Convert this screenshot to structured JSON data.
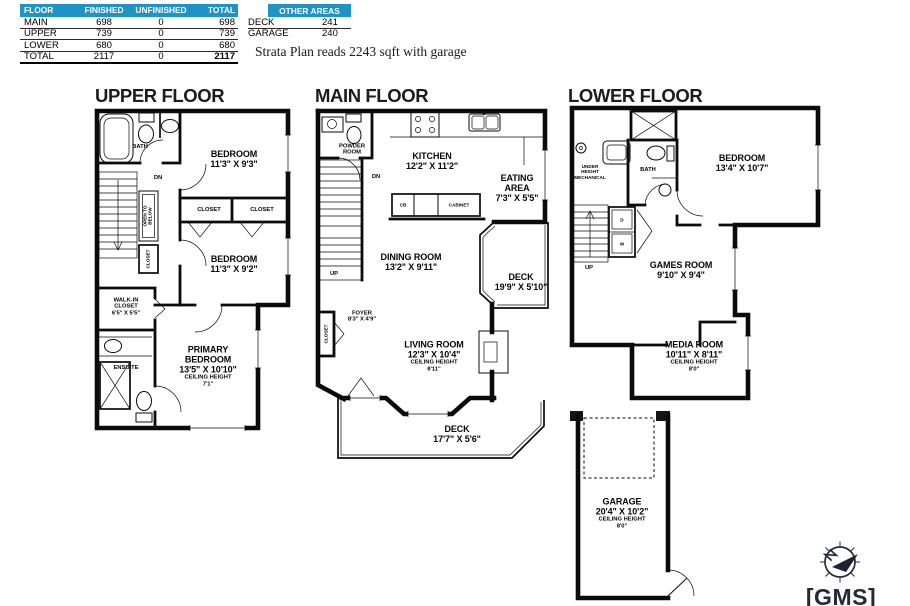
{
  "colors": {
    "header_blue": "#1e93c6",
    "wall_ink": "#0b0b0b",
    "logo_navy": "#232a38"
  },
  "summary_table": {
    "headers": [
      "FLOOR",
      "FINISHED",
      "UNFINISHED",
      "TOTAL"
    ],
    "rows": [
      [
        "MAIN",
        "698",
        "0",
        "698"
      ],
      [
        "UPPER",
        "739",
        "0",
        "739"
      ],
      [
        "LOWER",
        "680",
        "0",
        "680"
      ],
      [
        "TOTAL",
        "2117",
        "0",
        "2117"
      ]
    ]
  },
  "other_areas": {
    "title": "OTHER AREAS",
    "rows": [
      [
        "DECK",
        "241"
      ],
      [
        "GARAGE",
        "240"
      ]
    ]
  },
  "note": "Strata Plan reads 2243 sqft with garage",
  "upper_floor": {
    "title": "UPPER FLOOR",
    "labels": {
      "bath": "BATH",
      "dn": "DN",
      "bedroom1_name": "BEDROOM",
      "bedroom1_dims": "11'3\" X 9'3\"",
      "closet_a": "CLOSET",
      "closet_b": "CLOSET",
      "open_below_1": "OPEN TO",
      "open_below_2": "BELOW",
      "closet_vert": "CLOSET",
      "bedroom2_name": "BEDROOM",
      "bedroom2_dims": "11'3\" X 9'2\"",
      "walkin_1": "WALK-IN",
      "walkin_2": "CLOSET",
      "walkin_dims": "6'5\" X 5'5\"",
      "ensuite": "ENSUITE",
      "primary_1": "PRIMARY",
      "primary_2": "BEDROOM",
      "primary_dims": "13'5\" X 10'10\"",
      "primary_ch_label": "CEILING HEIGHT",
      "primary_ch": "7'1\""
    }
  },
  "main_floor": {
    "title": "MAIN FLOOR",
    "labels": {
      "powder_1": "POWDER",
      "powder_2": "ROOM",
      "kitchen_name": "KITCHEN",
      "kitchen_dims": "12'2\" X 11'2\"",
      "eating_1": "EATING",
      "eating_2": "AREA",
      "eating_dims": "7'3\" X 5'5\"",
      "cb": "CB",
      "cabinet": "CABINET",
      "dn": "DN",
      "up": "UP",
      "dining_name": "DINING ROOM",
      "dining_dims": "13'2\" X 9'11\"",
      "deck_side_name": "DECK",
      "deck_side_dims": "19'9\" X 5'10\"",
      "closet_vert": "CLOSET",
      "foyer_name": "FOYER",
      "foyer_dims": "8'3\" X 4'9\"",
      "living_name": "LIVING ROOM",
      "living_dims": "12'3\" X 10'4\"",
      "living_ch_label": "CEILING HEIGHT",
      "living_ch": "8'11\"",
      "deck_bottom_name": "DECK",
      "deck_bottom_dims": "17'7\" X 5'6\""
    }
  },
  "lower_floor": {
    "title": "LOWER FLOOR",
    "labels": {
      "mech_1": "UNDER",
      "mech_2": "HEIGHT",
      "mech_3": "MECHANICAL",
      "bath": "BATH",
      "bedroom_name": "BEDROOM",
      "bedroom_dims": "13'4\" X 10'7\"",
      "up": "UP",
      "dryer": "D",
      "washer": "W",
      "games_name": "GAMES ROOM",
      "games_dims": "9'10\" X 9'4\"",
      "media_name": "MEDIA ROOM",
      "media_dims": "10'11\" X 8'11\"",
      "media_ch_label": "CEILING HEIGHT",
      "media_ch": "8'0\"",
      "garage_name": "GARAGE",
      "garage_dims": "20'4\" X 10'2\"",
      "garage_ch_label": "CEILING HEIGHT",
      "garage_ch": "8'0\""
    }
  },
  "logo": {
    "text": "[GMS]"
  }
}
